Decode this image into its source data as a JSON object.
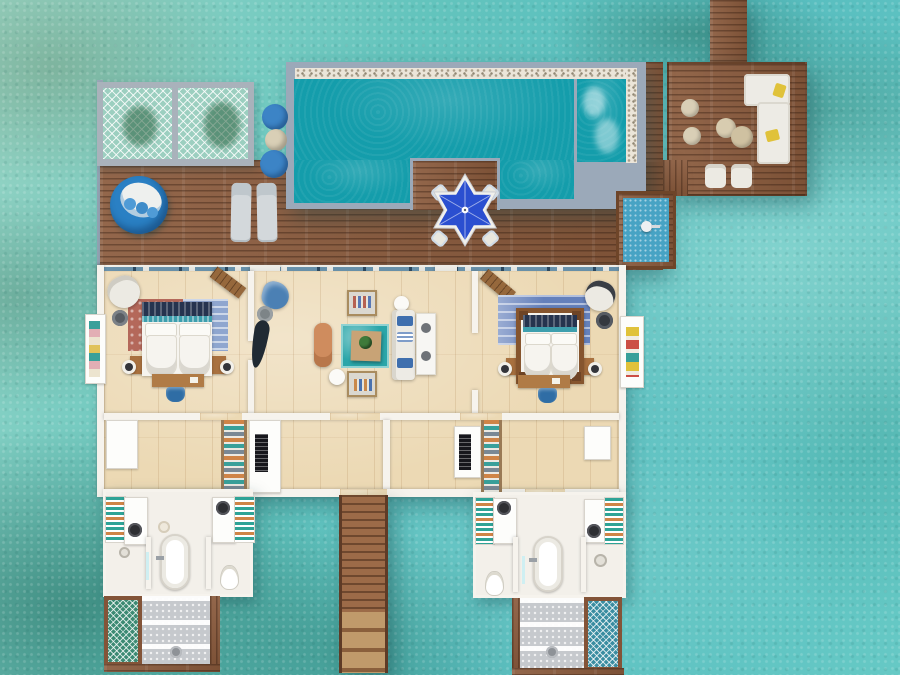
{
  "scene": {
    "title": "Two-bedroom overwater pool villa floor plan, top-down aerial rendering over a turquoise lagoon",
    "type": "floor-plan-rendering",
    "environment": "turquoise lagoon with coral patches"
  },
  "areas": [
    "jetty-walkway",
    "overwater-lounge-deck",
    "hammock-net-panels",
    "pool-deck",
    "swimming-pool",
    "jacuzzi",
    "pool-dining-peninsula",
    "outdoor-shower",
    "bedroom-left",
    "living-room",
    "bedroom-right",
    "dressing-area-left",
    "dressing-area-right",
    "bathroom-left",
    "bathroom-right",
    "rain-shower-left",
    "rain-shower-right",
    "catch-net-left",
    "catch-net-right",
    "sea-access-stairs",
    "balcony-nook-left",
    "balcony-nook-right"
  ],
  "furniture": {
    "lounge_deck": [
      "l-shaped-sofa",
      "yellow-cushions",
      "armchairs",
      "round-poufs",
      "coffee-tables"
    ],
    "pool_deck": [
      "round-daybed",
      "sun-loungers",
      "ottoman-poufs",
      "dining-umbrella",
      "dining-chairs"
    ],
    "bedroom_left": [
      "double-bed",
      "area-rug",
      "armchair",
      "side-table",
      "wood-bench",
      "desk",
      "stool",
      "table-lamps"
    ],
    "living_room": [
      "glass-floor-panel",
      "sofa",
      "coffee-table",
      "armchairs",
      "chaise-lounge",
      "blue-armchair",
      "palm-sculpture",
      "side-tables"
    ],
    "bedroom_right": [
      "four-poster-bed",
      "area-rug",
      "armchair",
      "side-table",
      "wood-bench",
      "desk",
      "stool",
      "table-lamps"
    ],
    "bathrooms": [
      "freestanding-bathtub",
      "double-vanities",
      "towel-shelves",
      "toilets",
      "rain-shower",
      "wardrobes",
      "ac-vent-cabinets"
    ]
  },
  "colors": {
    "water_base": "#5fc0bd",
    "deck_wood": "#8a5a3c",
    "dock_wood": "#9c6b48",
    "pool_trim": "#9ba9b9",
    "pebble": "#ebe5d9",
    "pool_water": "#149dab",
    "interior_floor": "#ecd9b4",
    "wall_white": "#f6f3ed",
    "window_blue": "#6f96b0",
    "window_navy": "#2e4a62",
    "mesh_teal": "#9ccfc0",
    "net_green": "#3c8a73",
    "net_blue": "#3a8da1",
    "tile_gray": "#c6c9cd",
    "umbrella_blue": "#2b4fd0",
    "daybed_blue": "#2a80c4",
    "pouf_blue": "#3c84c6",
    "accent_blue": "#2f6da5",
    "sofa_white": "#edebe5",
    "cushion_yellow": "#e0c23a",
    "wood_furniture": "#a9713f",
    "desk_wood": "#b07b46",
    "bench_wood": "#96683c",
    "headboard_navy": "#26344f",
    "teal_runner": "#3e9fae",
    "rug_red": "#b4685a",
    "rug_blue": "#6480bb",
    "towel_teal": "#2fa396",
    "towel_orange": "#cf8447",
    "chaise_orange": "#cf8c5e",
    "glass_floor": "#2aa6a9",
    "sand_table": "#c8a376",
    "plant_green": "#3e7a3a",
    "shower_blue": "#47a3c4",
    "cushion_red": "#cc4f45",
    "cushion_teal": "#39a09a",
    "beige_pouf": "#d9cfb6"
  }
}
